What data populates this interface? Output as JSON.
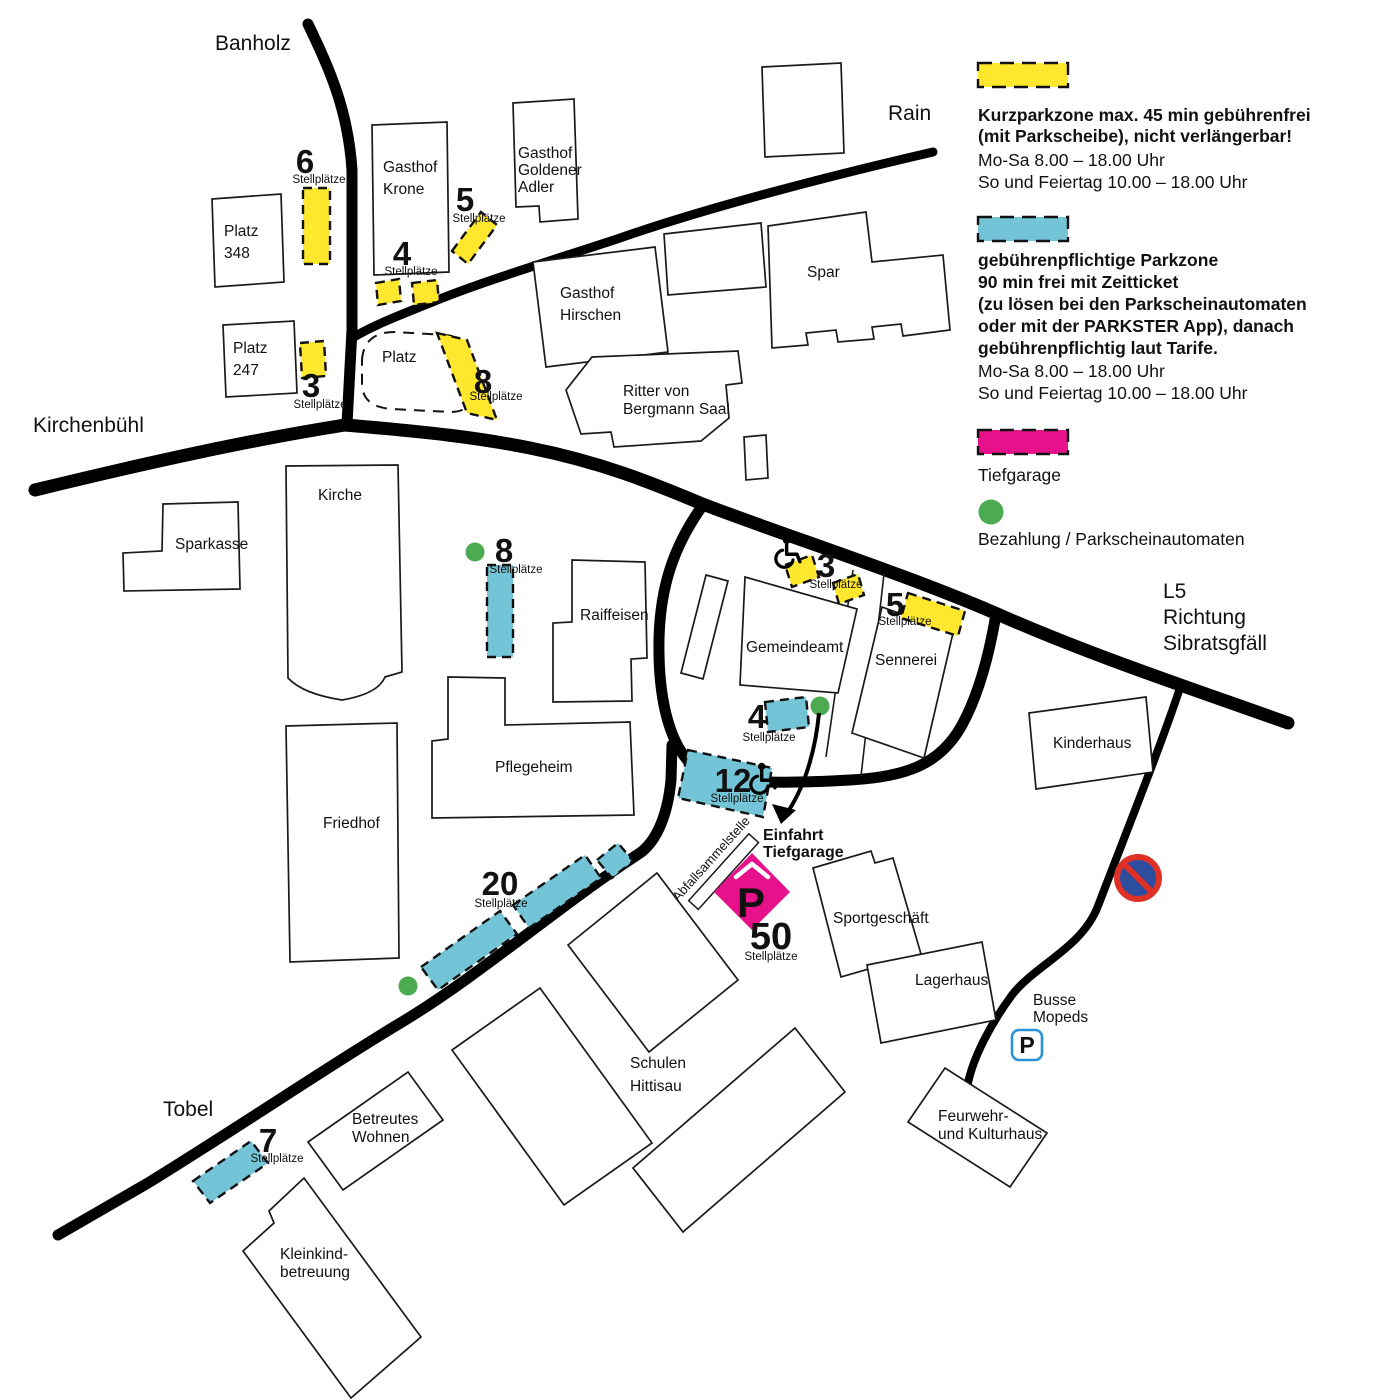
{
  "colors": {
    "kurzpark_fill": "#ffe72e",
    "kurzpark_text": "#f0b440",
    "parkzone_fill": "#74c4d7",
    "parkzone_text": "#1ca6e8",
    "tiefgarage_pink": "#e7118c",
    "payment_green": "#4cab50"
  },
  "legend": {
    "kurzpark": {
      "heading": [
        "Kurzparkzone max. 45 min gebührenfrei",
        "(mit Parkscheibe), nicht verlängerbar!"
      ],
      "hours": [
        "Mo-Sa 8.00 – 18.00 Uhr",
        "So und Feiertag 10.00 – 18.00 Uhr"
      ]
    },
    "gebuehren": {
      "heading": [
        "gebührenpflichtige Parkzone",
        "90 min frei mit Zeitticket",
        "(zu lösen bei den Parkscheinautomaten",
        "oder mit der PARKSTER App), danach",
        "gebührenpflichtig laut Tarife."
      ],
      "hours": [
        "Mo-Sa 8.00 – 18.00 Uhr",
        "So und Feiertag 10.00 – 18.00 Uhr"
      ]
    },
    "tiefgarage_label": "Tiefgarage",
    "bezahlung_label": "Bezahlung / Parkscheinautomaten"
  },
  "roads": {
    "banholz": "Banholz",
    "rain": "Rain",
    "kirchenbuehl": "Kirchenbühl",
    "tobel": "Tobel",
    "l5": [
      "L5",
      "Richtung",
      "Sibratsgfäll"
    ]
  },
  "buildings": {
    "platz348": [
      "Platz",
      "348"
    ],
    "platz247": [
      "Platz",
      "247"
    ],
    "gasthof_krone": [
      "Gasthof",
      "Krone"
    ],
    "gasthof_goldener_adler": [
      "Gasthof",
      "Goldener",
      "Adler"
    ],
    "gasthof_hirschen": [
      "Gasthof",
      "Hirschen"
    ],
    "spar": "Spar",
    "ritter": [
      "Ritter von",
      "Bergmann Saal"
    ],
    "kirche": "Kirche",
    "sparkasse": "Sparkasse",
    "raiffeisen": "Raiffeisen",
    "gemeindeamt": "Gemeindeamt",
    "sennerei": "Sennerei",
    "pflegeheim": "Pflegeheim",
    "friedhof": "Friedhof",
    "kinderhaus": "Kinderhaus",
    "sportgeschaeft": "Sportgeschäft",
    "lagerhaus": "Lagerhaus",
    "schulen": [
      "Schulen",
      "Hittisau"
    ],
    "betreutes_wohnen": [
      "Betreutes",
      "Wohnen"
    ],
    "kleinkind": [
      "Kleinkind-",
      "betreuung"
    ],
    "feuerwehr": [
      "Feurwehr-",
      "und Kulturhaus"
    ]
  },
  "labels": {
    "platz_dashed": "Platz",
    "einfahrt": [
      "Einfahrt",
      "Tiefgarage"
    ],
    "abfall": "Abfallsammelstelle",
    "busse": [
      "Busse",
      "Mopeds"
    ],
    "p_letter": "P"
  },
  "zones": {
    "unit": "Stellplätze",
    "kurzpark": [
      {
        "count": "6"
      },
      {
        "count": "5"
      },
      {
        "count": "4"
      },
      {
        "count": "3"
      },
      {
        "count": "8"
      },
      {
        "count": "3"
      },
      {
        "count": "5"
      }
    ],
    "parkzone": [
      {
        "count": "8"
      },
      {
        "count": "4"
      },
      {
        "count": "12"
      },
      {
        "count": "20"
      },
      {
        "count": "7"
      }
    ],
    "tiefgarage": {
      "count": "50"
    }
  }
}
